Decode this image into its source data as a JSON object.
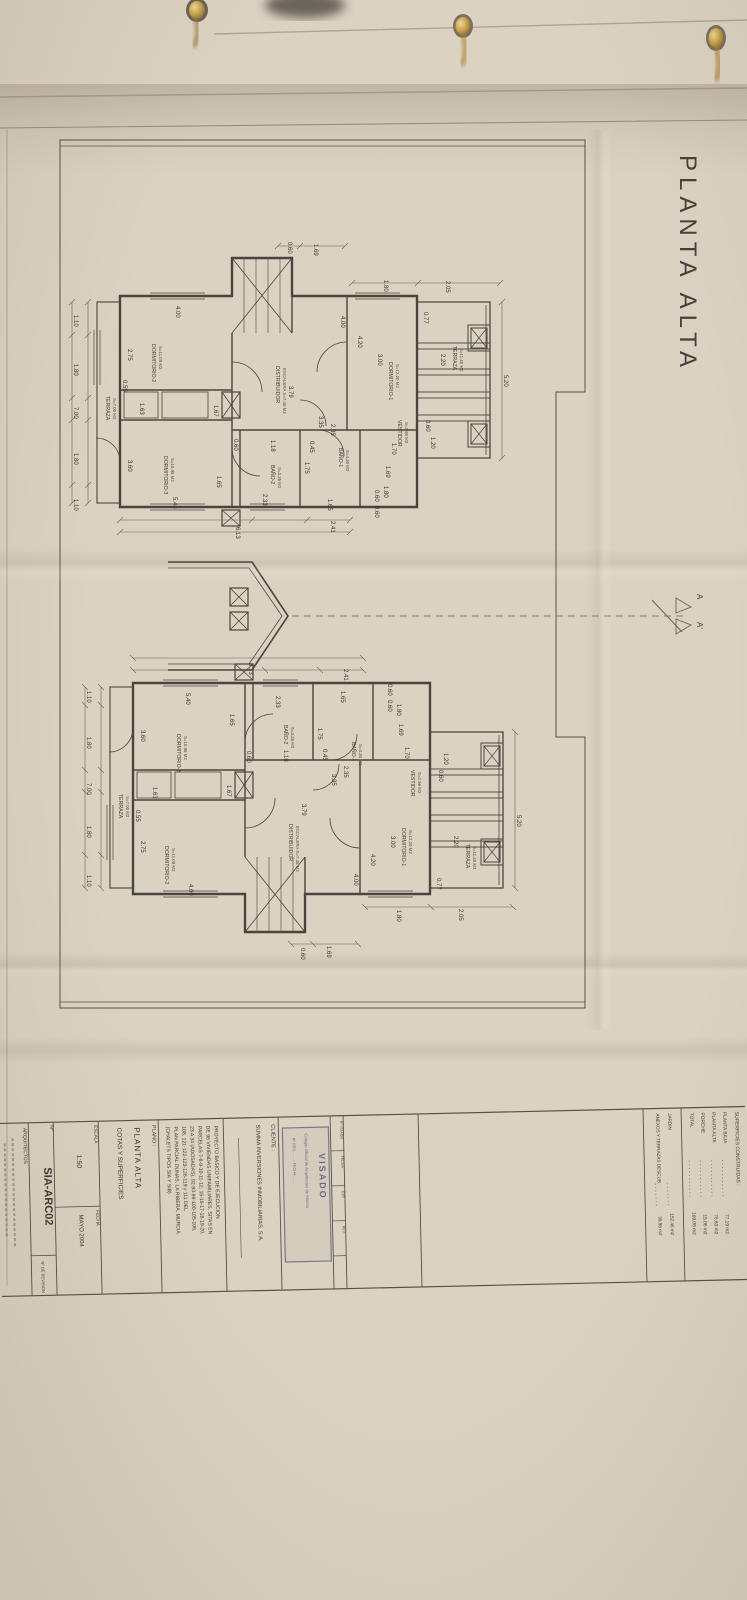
{
  "sheet": {
    "title": "PLANTA ALTA",
    "section_marker_top": "A",
    "section_marker_bottom": "A'"
  },
  "plans": {
    "dims": [
      {
        "v": "0.60",
        "x": 288,
        "y": 242
      },
      {
        "v": "1.69",
        "x": 314,
        "y": 244
      },
      {
        "v": "1.80",
        "x": 384,
        "y": 280
      },
      {
        "v": "2.05",
        "x": 446,
        "y": 281
      },
      {
        "v": "4.00",
        "x": 176,
        "y": 306
      },
      {
        "v": "4.00",
        "x": 341,
        "y": 316
      },
      {
        "v": "3.00",
        "x": 378,
        "y": 354
      },
      {
        "v": "4.20",
        "x": 358,
        "y": 336
      },
      {
        "v": "2.75",
        "x": 128,
        "y": 349
      },
      {
        "v": "0.55",
        "x": 123,
        "y": 380
      },
      {
        "v": "1.63",
        "x": 140,
        "y": 403
      },
      {
        "v": "1.67",
        "x": 214,
        "y": 405
      },
      {
        "v": "3.60",
        "x": 128,
        "y": 460
      },
      {
        "v": "1.65",
        "x": 217,
        "y": 476
      },
      {
        "v": "5.40",
        "x": 173,
        "y": 497
      },
      {
        "v": "2.33",
        "x": 263,
        "y": 494
      },
      {
        "v": "0.60",
        "x": 234,
        "y": 439
      },
      {
        "v": "1.18",
        "x": 271,
        "y": 440
      },
      {
        "v": "0.45",
        "x": 310,
        "y": 441
      },
      {
        "v": "2.35",
        "x": 331,
        "y": 424
      },
      {
        "v": "1.75",
        "x": 305,
        "y": 462
      },
      {
        "v": "3.35",
        "x": 319,
        "y": 416
      },
      {
        "v": "1.70",
        "x": 392,
        "y": 443
      },
      {
        "v": "1.65",
        "x": 328,
        "y": 499
      },
      {
        "v": "1.80",
        "x": 384,
        "y": 486
      },
      {
        "v": "0.60",
        "x": 375,
        "y": 490
      },
      {
        "v": "0.60",
        "x": 375,
        "y": 506
      },
      {
        "v": "1.69",
        "x": 386,
        "y": 466
      },
      {
        "v": "2.41",
        "x": 331,
        "y": 521
      },
      {
        "v": "6.13",
        "x": 236,
        "y": 527,
        "mv": "8.13"
      },
      {
        "v": "0.77",
        "x": 424,
        "y": 312
      },
      {
        "v": "2.20",
        "x": 441,
        "y": 354
      },
      {
        "v": "5.20",
        "x": 504,
        "y": 375
      },
      {
        "v": "0.60",
        "x": 426,
        "y": 420
      },
      {
        "v": "1.20",
        "x": 431,
        "y": 437
      },
      {
        "v": "3.79",
        "x": 289,
        "y": 386
      },
      {
        "v": "1.10",
        "x": 74,
        "y": 315
      },
      {
        "v": "1.80",
        "x": 74,
        "y": 364
      },
      {
        "v": "7.00",
        "x": 74,
        "y": 407
      },
      {
        "v": "1.80",
        "x": 74,
        "y": 453
      },
      {
        "v": "1.10",
        "x": 74,
        "y": 499
      }
    ],
    "rooms": [
      {
        "n": "DORMITORIO-2",
        "a": "S=11.09 M2",
        "x": 152,
        "y": 344
      },
      {
        "n": "DORMITORIO-3",
        "a": "S=10.95 M2",
        "x": 164,
        "y": 456
      },
      {
        "n": "DORMITORIO-1",
        "a": "S=12.20 M2",
        "x": 389,
        "y": 362
      },
      {
        "n": "VESTIDOR",
        "a": "S=2.96 M2",
        "x": 398,
        "y": 420
      },
      {
        "n": "BAÑO-1",
        "a": "S=4.30 M2",
        "x": 339,
        "y": 448
      },
      {
        "n": "BAÑO-2",
        "a": "S=3.35 M2",
        "x": 271,
        "y": 465
      },
      {
        "n": "DISTRIBUIDOR",
        "a": "ESCALERA S=7.45 M2",
        "x": 276,
        "y": 366
      },
      {
        "n": "TERRAZA",
        "a": "S=7.00 M2",
        "x": 106,
        "y": 396
      },
      {
        "n": "TERRAZA",
        "a": "S=11.40 M2",
        "x": 453,
        "y": 346
      }
    ]
  },
  "title_block": {
    "cliente_label": "CLIENTE :",
    "cliente": "SUMMA INVERSIONES INMOBILIARIAS, S.A.",
    "proyecto_lines": [
      "PROYECTO BASICO Y DE EJECUCION",
      "DE 96 VIVIENDAS UNIFAMILIARES, SITAS EN",
      "PARCELAS 7-8-9-10-11-12, 15-16-17-18-19-20,",
      "23 A 34 (ADOSADAS), 92-93-99-100-105-106,",
      "108, 121-122-123-126-119 y 111 DEL",
      "PLAN PARCIAL DUNAS, LA RIBERA, MURCIA.",
      "(CHALETS TIPOS SIA Y SIB)"
    ],
    "plano_label": "PLANO :",
    "plano_title": "PLANTA ALTA",
    "plano_subtitle": "COTAS Y SUPERFICIES",
    "escala_label": "ESCALA",
    "escala_value": "1:50",
    "fecha_label": "FECHA",
    "fecha_value": "MAYO 2004",
    "numero_label": "Nº",
    "numero_value": "SIA-ARC02",
    "revision_label": "Nº DE REVISION",
    "arquitectos_label": "ARQUITECTOS",
    "visado": {
      "title": "VISADO",
      "org": "Colegio Oficial de Arquitectos de Murcia",
      "fields": "Nº REG. ........  FECHA ........",
      "side_cells": [
        "Nº VISADO",
        "FECHA",
        "EXP.",
        "REV."
      ]
    },
    "superficies": {
      "header": "SUPERFICIES CONSTRUIDAS :",
      "rows": [
        {
          "label": "PLANTA BAJA",
          "value": "77.19 m2"
        },
        {
          "label": "PLANTA ALTA",
          "value": "76.83 m2"
        },
        {
          "label": "PORCHE",
          "value": "15.06 m2"
        },
        {
          "label": "TOTAL",
          "value": "169.08 m2"
        }
      ],
      "extra_rows": [
        {
          "label": "JARDIN",
          "value": "152.46 m2"
        },
        {
          "label": "ANEXOS Y TERRAZAS DESCUB.",
          "value": "30.98 m2"
        }
      ]
    }
  }
}
